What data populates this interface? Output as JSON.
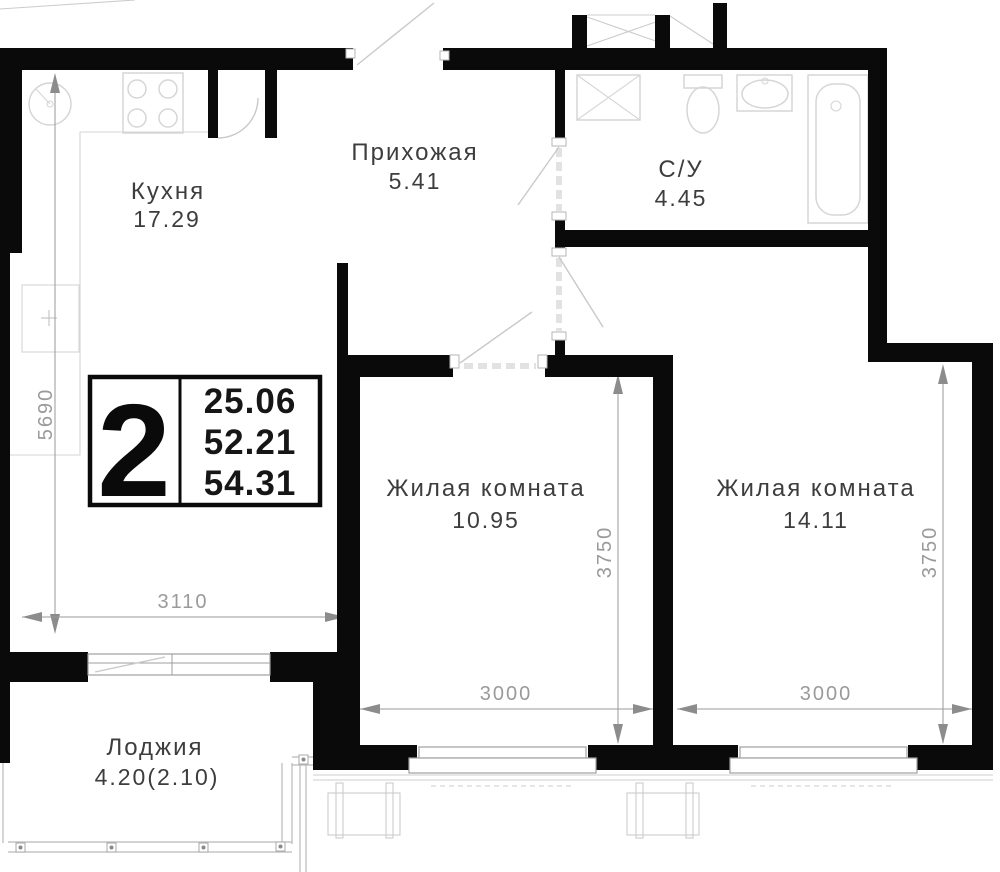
{
  "colors": {
    "wall": "#0a0a0a",
    "label": "#3d3d3d",
    "dim": "#9a9a9a",
    "arrow": "#8c8c8c",
    "fixture": "#d6d6d6",
    "swing": "#c9c9c9",
    "dash": "#e2e2e2",
    "glazing": "#b9b9b9",
    "facade": "#cccccc"
  },
  "badge": {
    "room_count": "2",
    "areas": [
      "25.06",
      "52.21",
      "54.31"
    ]
  },
  "rooms": [
    {
      "name": "Кухня",
      "area": "17.29"
    },
    {
      "name": "Прихожая",
      "area": "5.41"
    },
    {
      "name": "С/У",
      "area": "4.45"
    },
    {
      "name": "Жилая комната",
      "area": "10.95"
    },
    {
      "name": "Жилая комната",
      "area": "14.11"
    },
    {
      "name": "Лоджия",
      "area": "4.20(2.10)"
    }
  ],
  "dimensions": {
    "kitchen_height_mm": "5690",
    "kitchen_width_mm": "3110",
    "room1_width_mm": "3000",
    "room1_height_mm": "3750",
    "room2_width_mm": "3000",
    "room2_height_mm": "3750"
  }
}
